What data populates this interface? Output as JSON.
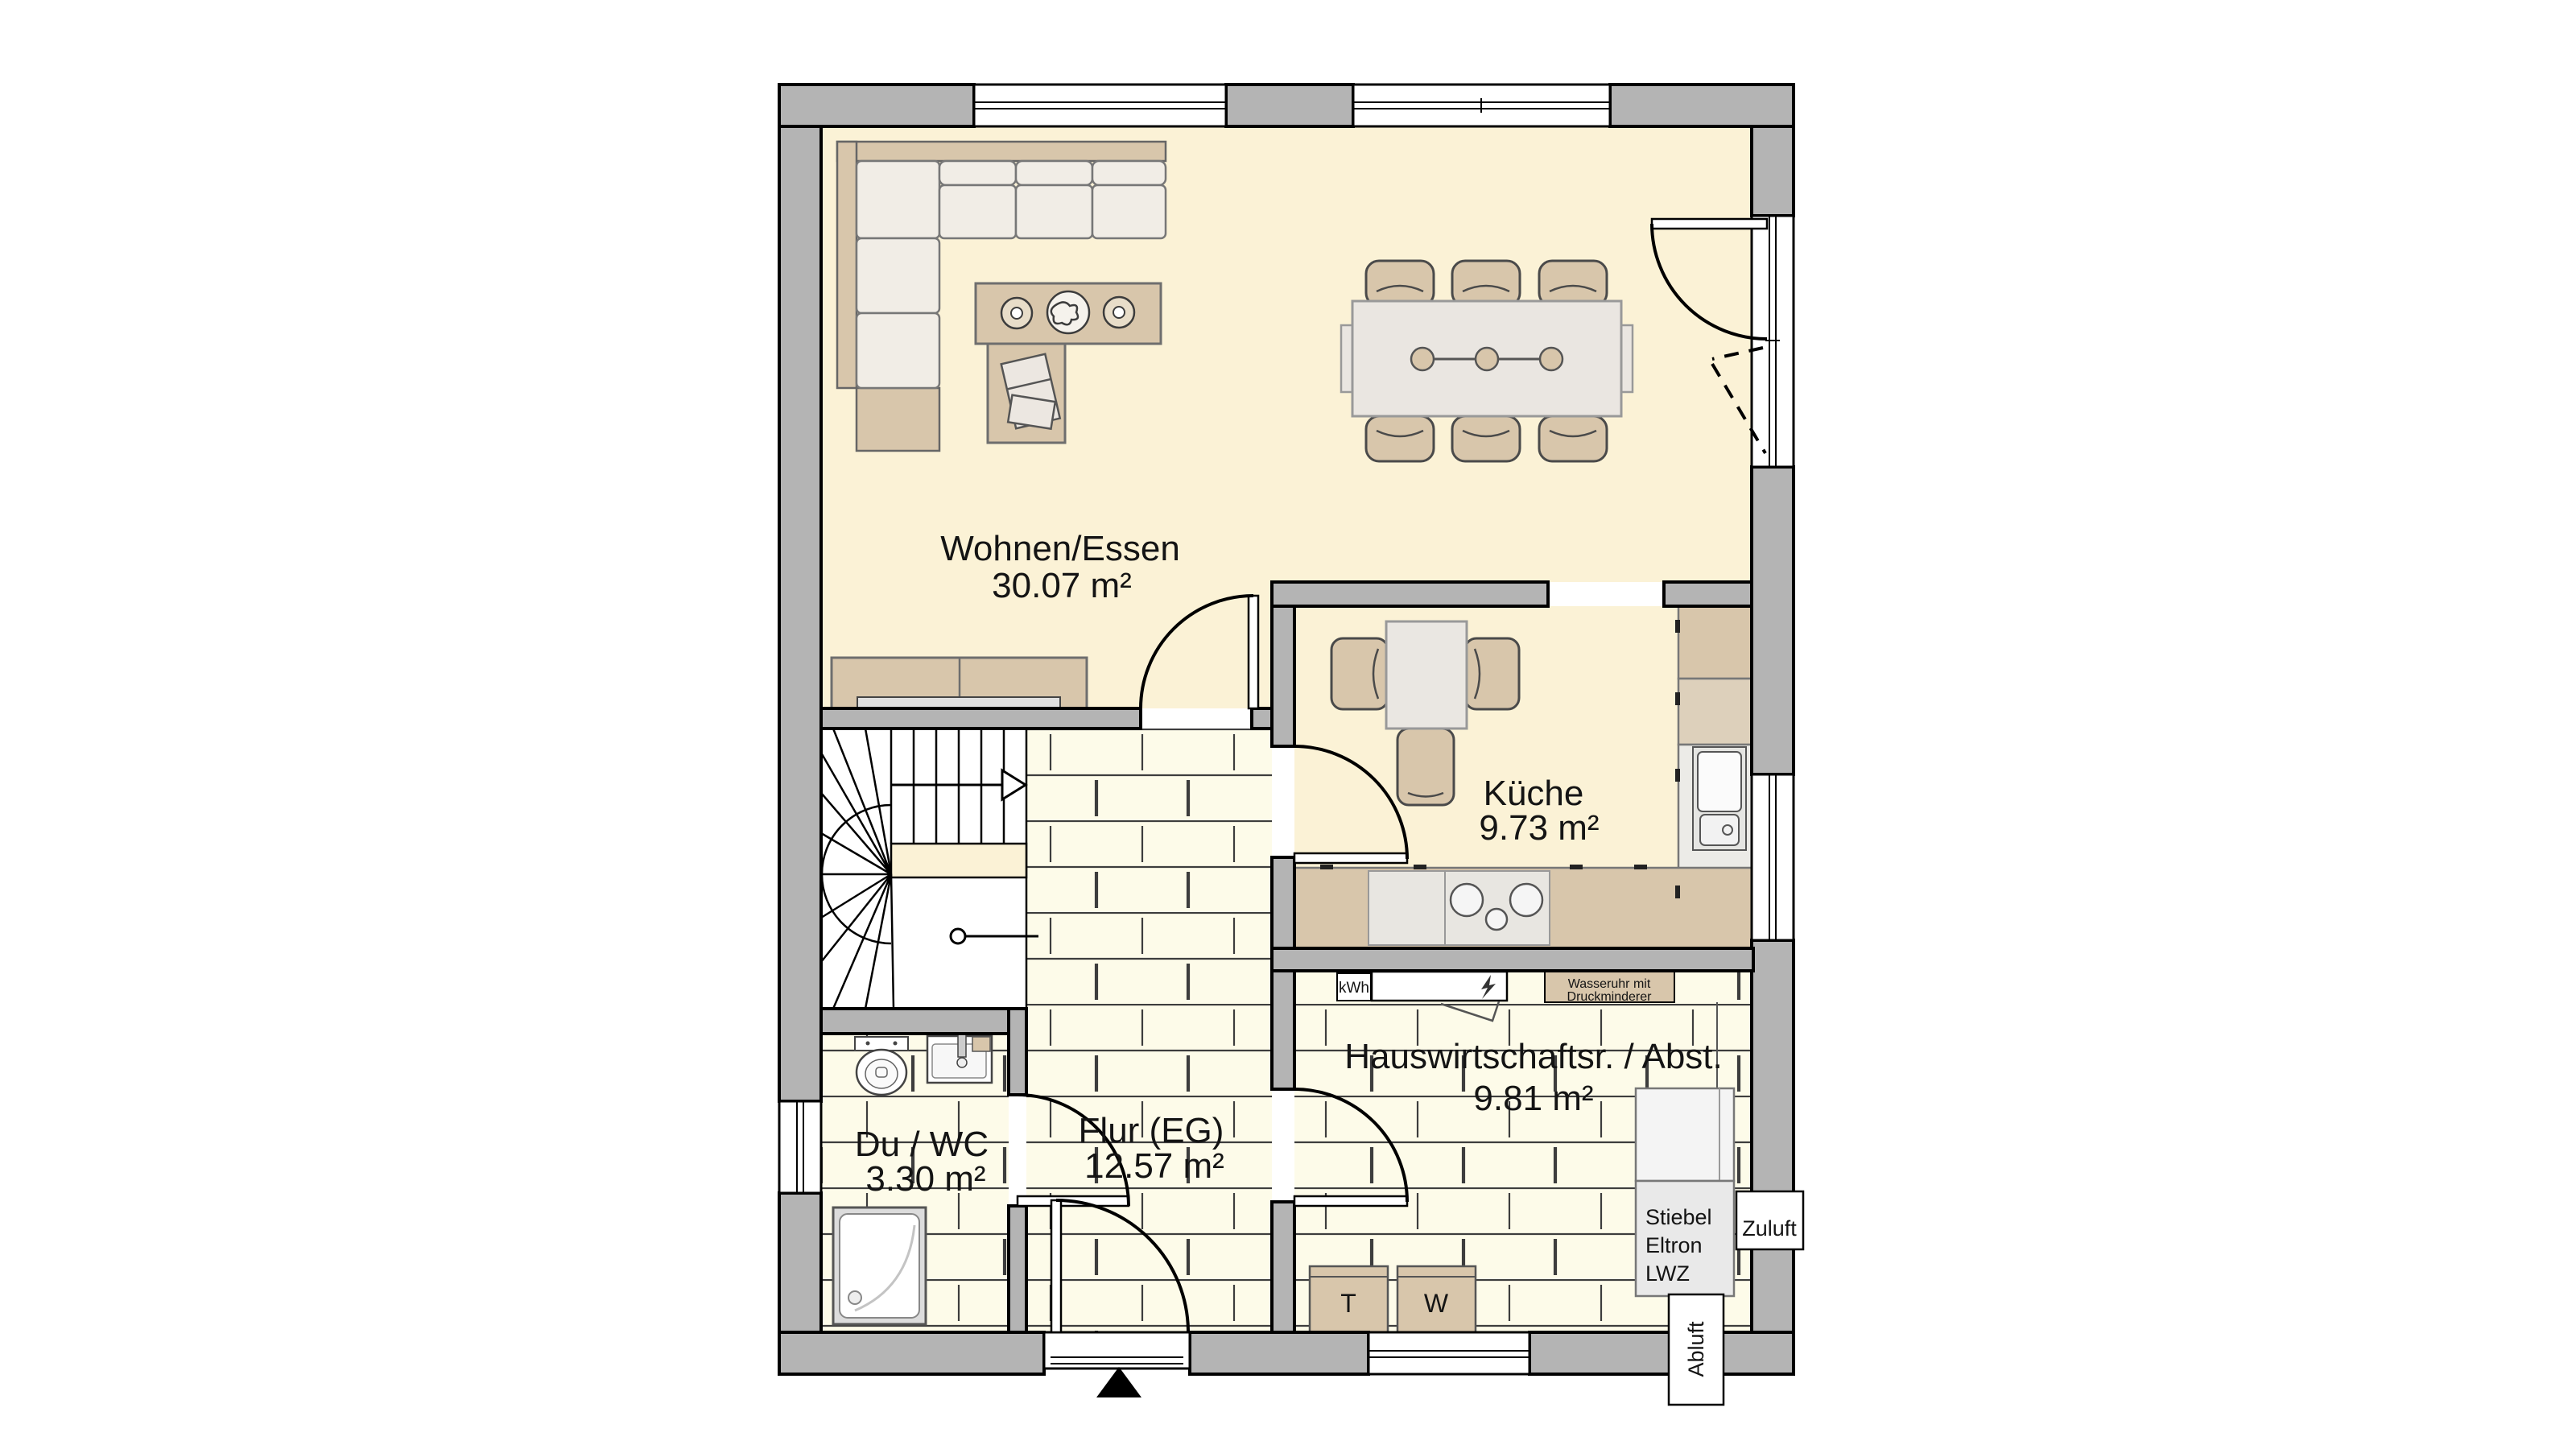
{
  "rooms": {
    "living": {
      "name": "Wohnen/Essen",
      "area": "30.07 m²"
    },
    "kitchen": {
      "name": "Küche",
      "area": "9.73 m²"
    },
    "hall": {
      "name": "Flur (EG)",
      "area": "12.57 m²"
    },
    "bath": {
      "name": "Du / WC",
      "area": "3.30 m²"
    },
    "utility": {
      "name": "Hauswirtschaftsr. / Abst.",
      "area": "9.81 m²"
    }
  },
  "equipment": {
    "electric_meter": "kWh",
    "water_meter": {
      "line1": "Wasseruhr mit",
      "line2": "Druckminderer"
    },
    "heat_pump": {
      "line1": "Stiebel",
      "line2": "Eltron",
      "line3": "LWZ"
    },
    "supply_air": "Zuluft",
    "exhaust_air": "Abluft",
    "dryer": "T",
    "washer": "W"
  },
  "colors": {
    "wall": "#b4b4b4",
    "outline": "#000000",
    "floor_main": "#fbf2d6",
    "floor_tile": "#fdfbe9",
    "furniture_tan": "#d8c6ab",
    "cushion": "#f1ede6",
    "counter": "#ecebe7"
  }
}
